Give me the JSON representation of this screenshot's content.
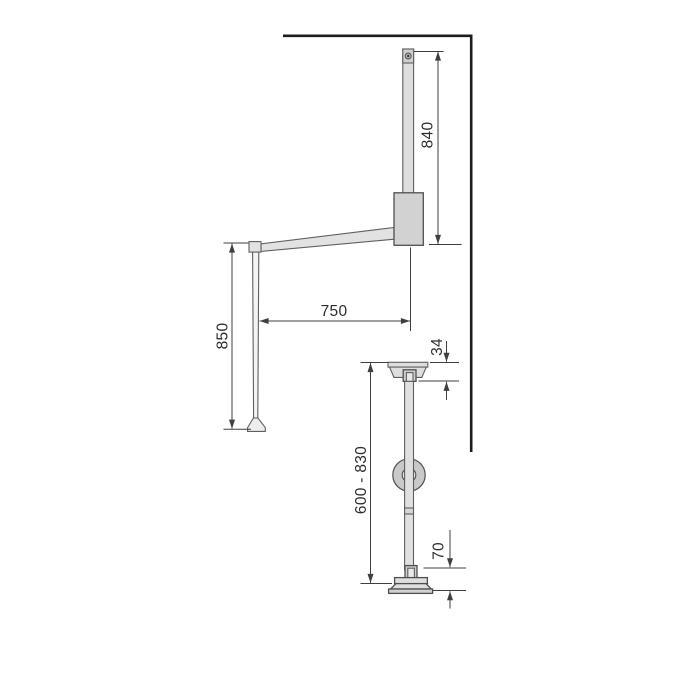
{
  "colors": {
    "background": "#ffffff",
    "wall_line": "#1d1d1d",
    "part_outline": "#5f5f5f",
    "dimension_line": "#3f3f3f",
    "label_text": "#2d2d2d",
    "part_fill_light": "#e2e2e2",
    "part_fill_mid": "#d2d2d2"
  },
  "dimensions": {
    "bar_height": "840",
    "arm_reach": "750",
    "rod_drop": "850",
    "cap_height": "34",
    "rail_adjustable_height": "600 - 830",
    "base_height": "70"
  }
}
